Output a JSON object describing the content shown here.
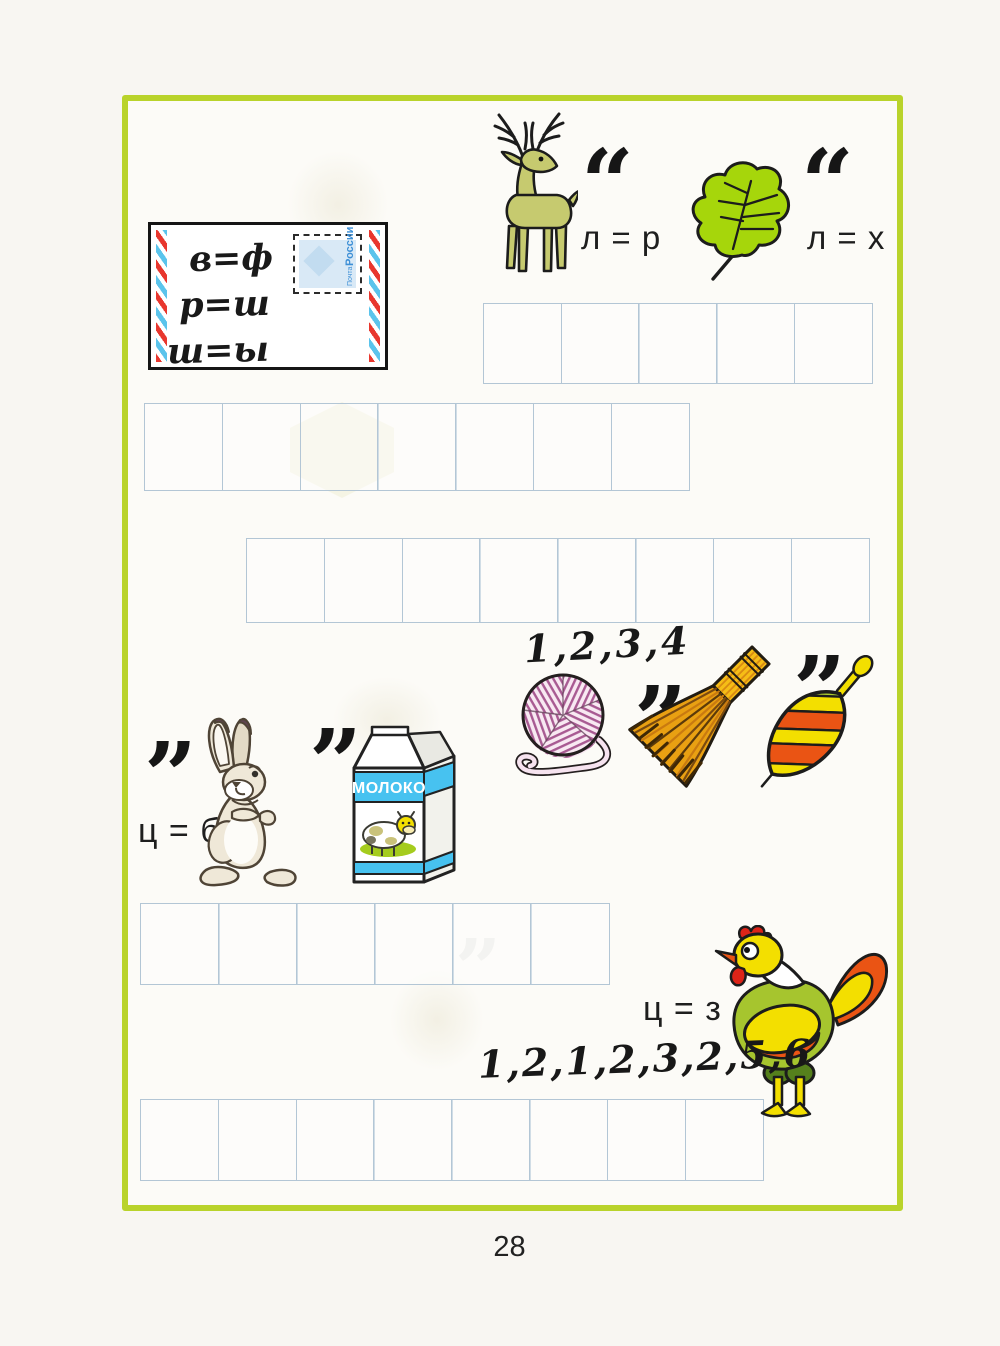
{
  "page": {
    "number": "28"
  },
  "colors": {
    "frame_green": "#b9d32b",
    "grid_line_blue": "#b3c6d5",
    "leaf_green": "#a6d60b",
    "deer_olive": "#c6ca6f",
    "rooster_green": "#a6c52e",
    "accent_yellow": "#f2d800",
    "accent_orange": "#e75317",
    "accent_red": "#dc2418",
    "yarn_pink": "#b06399",
    "milk_blue": "#47c2f0",
    "ink_black": "#161616"
  },
  "envelope": {
    "substitutions": [
      "в=ф",
      "р=ш",
      "ш=ы"
    ],
    "line1": "в=ф",
    "line2": "р=ш",
    "line3": "ш=ы",
    "stamp_line1": "Почта",
    "stamp_line2": "России"
  },
  "puzzle_deer_leaf": {
    "quote_deer": "“",
    "rule_deer": "л = р",
    "quote_leaf": "“",
    "rule_leaf": "л = х"
  },
  "puzzle_yarn_broom_top": {
    "numbers": "1,2,3,4",
    "quote_yarn": "”",
    "quote_broom": "”"
  },
  "puzzle_hare_milk": {
    "quote_hare": "”",
    "rule_hare": "ц = б",
    "quote_milk": "”",
    "milk_label": "МОЛОКО"
  },
  "puzzle_rooster": {
    "rule_rooster": "ц = з",
    "numbers": "1,2,1,2,3,2,5,6"
  },
  "grids": [
    {
      "name": "answer-grid-1",
      "cells": 5
    },
    {
      "name": "answer-grid-2",
      "cells": 7
    },
    {
      "name": "answer-grid-3",
      "cells": 8
    },
    {
      "name": "answer-grid-4",
      "cells": 6
    },
    {
      "name": "answer-grid-5",
      "cells": 8
    }
  ],
  "ghost_quote": "”"
}
